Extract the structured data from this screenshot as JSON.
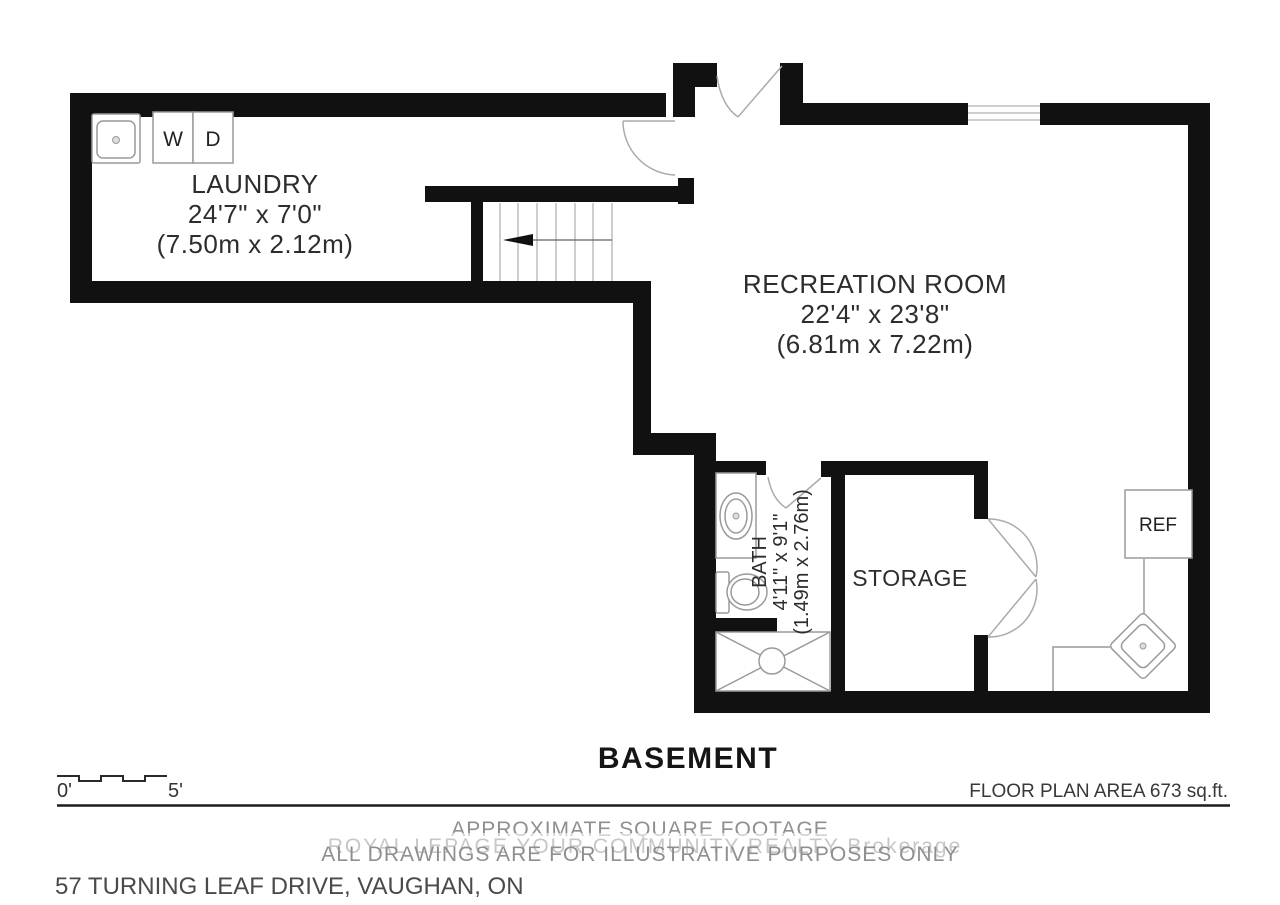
{
  "rooms": {
    "laundry": {
      "name": "LAUNDRY",
      "dims_imperial": "24'7\" x 7'0\"",
      "dims_metric": "(7.50m x 2.12m)"
    },
    "recreation": {
      "name": "RECREATION ROOM",
      "dims_imperial": "22'4\" x 23'8\"",
      "dims_metric": "(6.81m x 7.22m)"
    },
    "bath": {
      "name": "BATH",
      "dims_imperial": "4'11\" x 9'1\"",
      "dims_metric": "(1.49m x 2.76m)"
    },
    "storage": {
      "name": "STORAGE"
    }
  },
  "fixtures": {
    "washer": "W",
    "dryer": "D",
    "fridge": "REF"
  },
  "scale": {
    "zero": "0'",
    "five": "5'"
  },
  "footer": {
    "title": "BASEMENT",
    "area_note": "FLOOR PLAN AREA 673 sq.ft.",
    "disclaimer1": "APPROXIMATE SQUARE FOOTAGE",
    "disclaimer2": "ALL DRAWINGS ARE FOR ILLUSTRATIVE PURPOSES ONLY",
    "address": "57 TURNING LEAF DRIVE, VAUGHAN, ON",
    "watermark": "ROYAL LEPAGE YOUR COMMUNITY REALTY Brokerage"
  },
  "colors": {
    "wall": "#111111",
    "fixture_line": "#9a9a9a",
    "note_gray": "#8f8f8f",
    "watermark_gray": "#c7c7c7"
  }
}
